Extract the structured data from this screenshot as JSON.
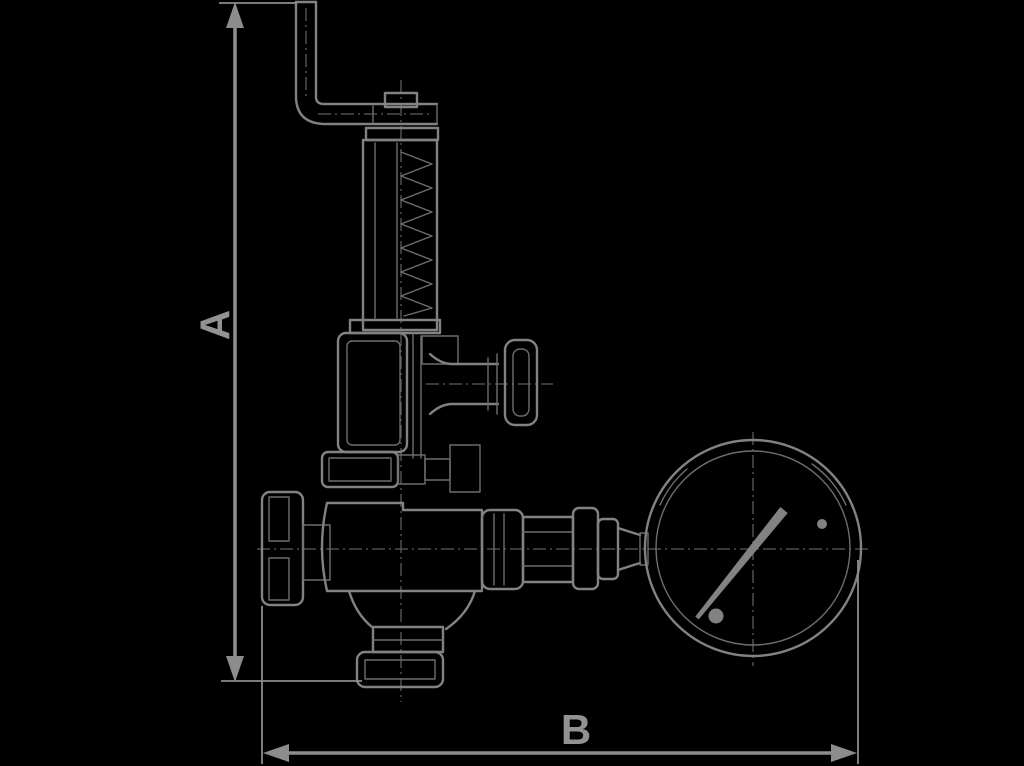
{
  "page": {
    "background_color": "#000000",
    "line_color": "#828282",
    "description": "Dimensional outline drawing of a safety relief valve with test lever, spring housing, side handwheel and pressure gauge"
  },
  "dimensions": {
    "vertical": {
      "label": "A"
    },
    "horizontal": {
      "label": "B"
    }
  },
  "components": [
    {
      "name": "test-lever"
    },
    {
      "name": "spring-housing"
    },
    {
      "name": "spring-bonnet"
    },
    {
      "name": "adjustment-handwheel"
    },
    {
      "name": "upper-flange"
    },
    {
      "name": "inlet-flange"
    },
    {
      "name": "valve-body"
    },
    {
      "name": "outlet-flange"
    },
    {
      "name": "gauge-piping"
    },
    {
      "name": "pressure-gauge"
    }
  ]
}
